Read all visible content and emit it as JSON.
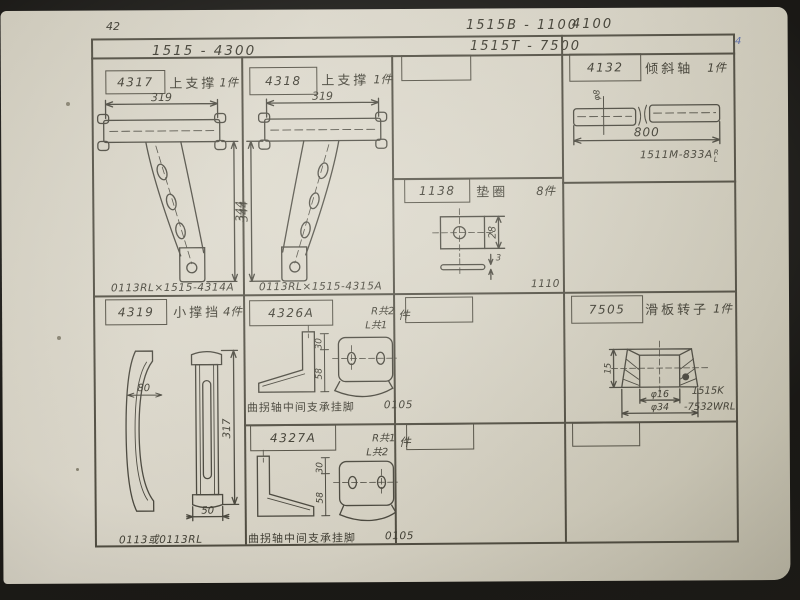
{
  "header": {
    "page_number": "42",
    "code_line1": "1515B - 1100",
    "code_line1_right": "4100",
    "code_line2": "1515T - 7500",
    "series": "1515 - 4300",
    "corner_pen_mark": "4"
  },
  "cells": {
    "c4317": {
      "part_no": "4317",
      "name": "上支撑",
      "qty": "1件",
      "dims": {
        "width": "319",
        "height": "344"
      },
      "caption": "0113RL×1515-4314A"
    },
    "c4318": {
      "part_no": "4318",
      "name": "上支撑",
      "qty": "1件",
      "dims": {
        "width": "319",
        "height": "344"
      },
      "caption": "0113RL×1515-4315A"
    },
    "c4132": {
      "part_no": "4132",
      "name": "倾斜轴",
      "qty": "1件",
      "dims": {
        "dia": "φ8",
        "length": "800"
      },
      "caption": "1511M-833A",
      "caption_sup": "R",
      "caption_sub": "L"
    },
    "c1138": {
      "part_no": "1138",
      "name": "垫圈",
      "qty": "8件",
      "dims": {
        "height": "28",
        "thickness": "3"
      },
      "caption": "1110"
    },
    "c4319": {
      "part_no": "4319",
      "name": "小撑挡",
      "qty": "4件",
      "dims": {
        "width": "80",
        "height": "317",
        "foot": "50"
      },
      "caption": "0113或0113RL"
    },
    "c4326a": {
      "part_no": "4326A",
      "qty_r": "R共2",
      "qty_l": "L共1",
      "qty_unit": "件",
      "dims": {
        "top": "30",
        "height": "58"
      },
      "caption": "曲拐轴中间支承挂脚",
      "caption_code": "0105"
    },
    "c4327a": {
      "part_no": "4327A",
      "qty_r": "R共1",
      "qty_l": "L共2",
      "qty_unit": "件",
      "dims": {
        "top": "30",
        "height": "58"
      },
      "caption": "曲拐轴中间支承挂脚",
      "caption_code": "0105"
    },
    "c7505": {
      "part_no": "7505",
      "name": "滑板转子",
      "qty": "1件",
      "dims": {
        "height": "15",
        "bore": "φ16",
        "outer": "φ34"
      },
      "note1": "1515K",
      "note2": "-7532WRL"
    }
  }
}
